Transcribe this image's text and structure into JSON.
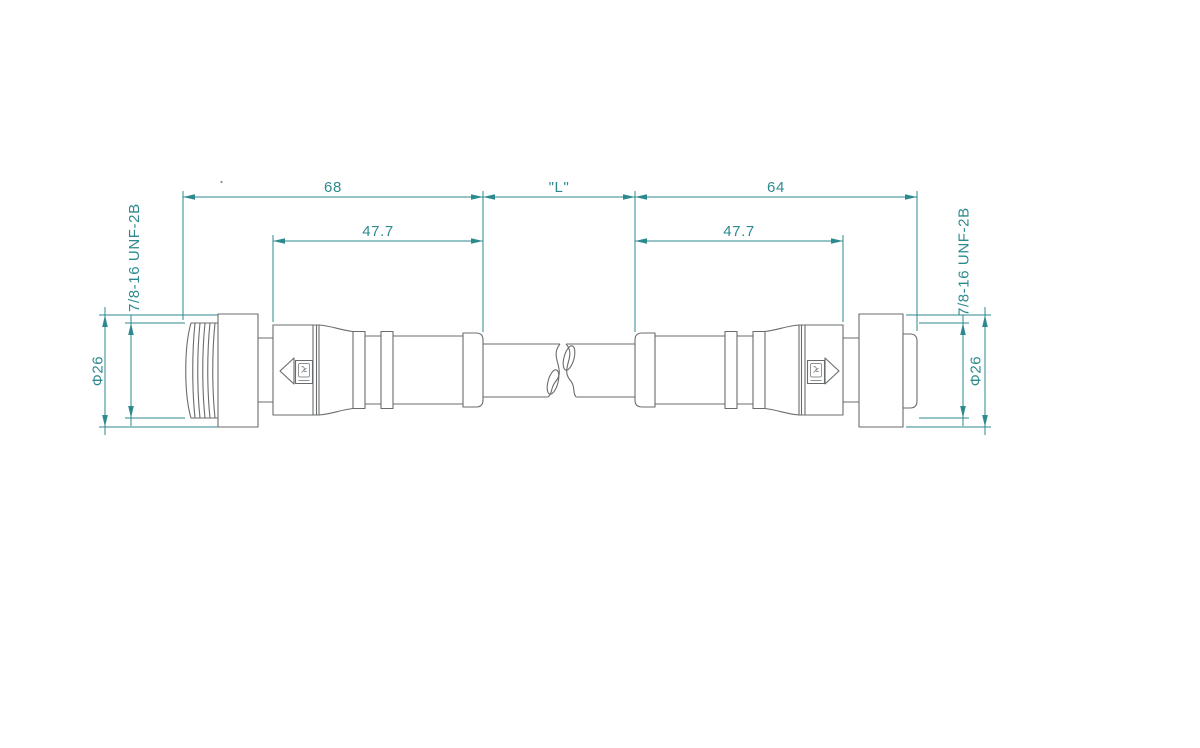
{
  "labels": {
    "overall_left": "68",
    "cable_length": "\"L\"",
    "overall_right": "64",
    "body_left": "47.7",
    "body_right": "47.7",
    "thread_left": "7/8-16 UNF-2B",
    "thread_right": "7/8-16 UNF-2B",
    "diameter_left": "Φ26",
    "diameter_right": "Φ26"
  },
  "colors": {
    "dimension": "#2c8a8e",
    "outline": "#696c6e",
    "background": "#ffffff"
  }
}
